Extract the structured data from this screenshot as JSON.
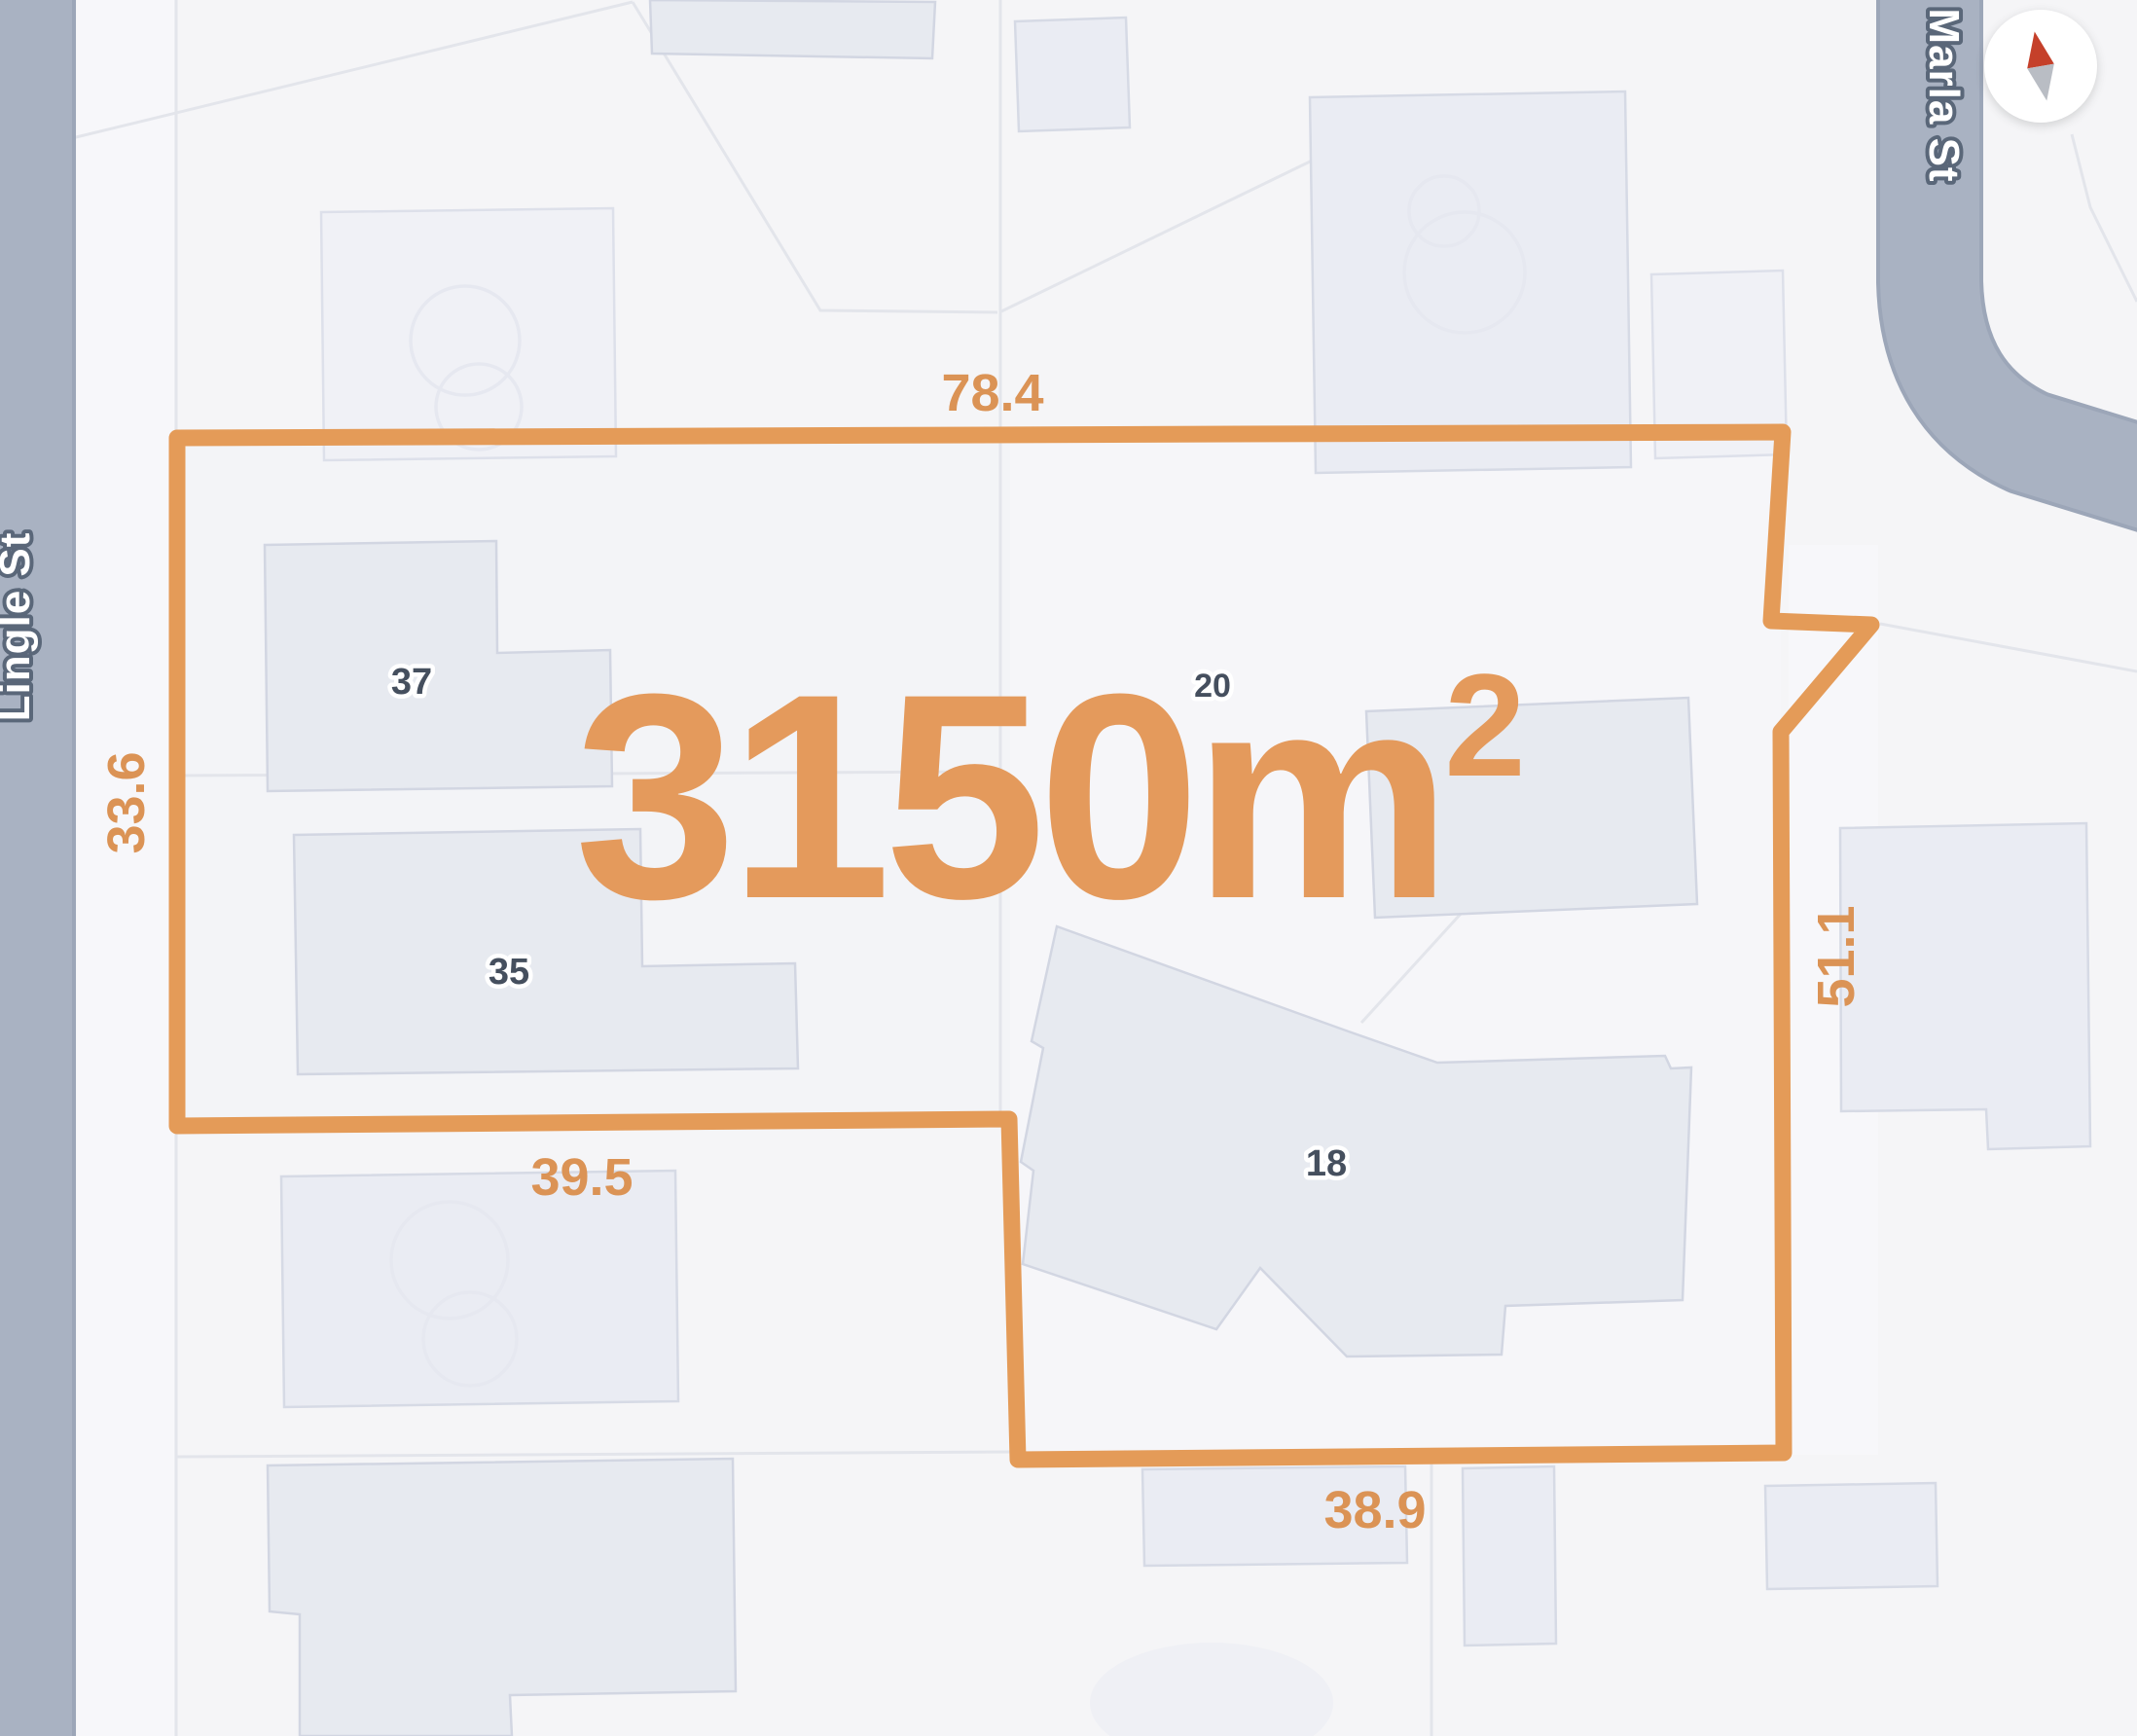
{
  "map": {
    "area_label": {
      "text": "3150m",
      "superscript": "2"
    },
    "measurements": {
      "top": "78.4",
      "left": "33.6",
      "bottom_left": "39.5",
      "bottom": "38.9",
      "right": "51.1"
    },
    "streets": {
      "left": "Lingle St",
      "right": "Marla St"
    },
    "house_numbers": {
      "h37": "37",
      "h35": "35",
      "h18": "18",
      "h20": "20"
    },
    "colors": {
      "parcel_outline": "#E49B58",
      "area_text": "#E49A5C",
      "measurement_text": "#DB9355",
      "road_fill": "#A9B2C2",
      "road_edge": "#9CA6B8",
      "road_label_fill": "#FFFFFF",
      "road_label_outline": "#5A6779",
      "background": "#F5F5F7",
      "building_fill": "#E7EAF0",
      "building_border": "#D2D6E2",
      "house_number_text": "#454F5E",
      "compass_north": "#C5402A",
      "compass_south": "#B9BDC4"
    }
  }
}
